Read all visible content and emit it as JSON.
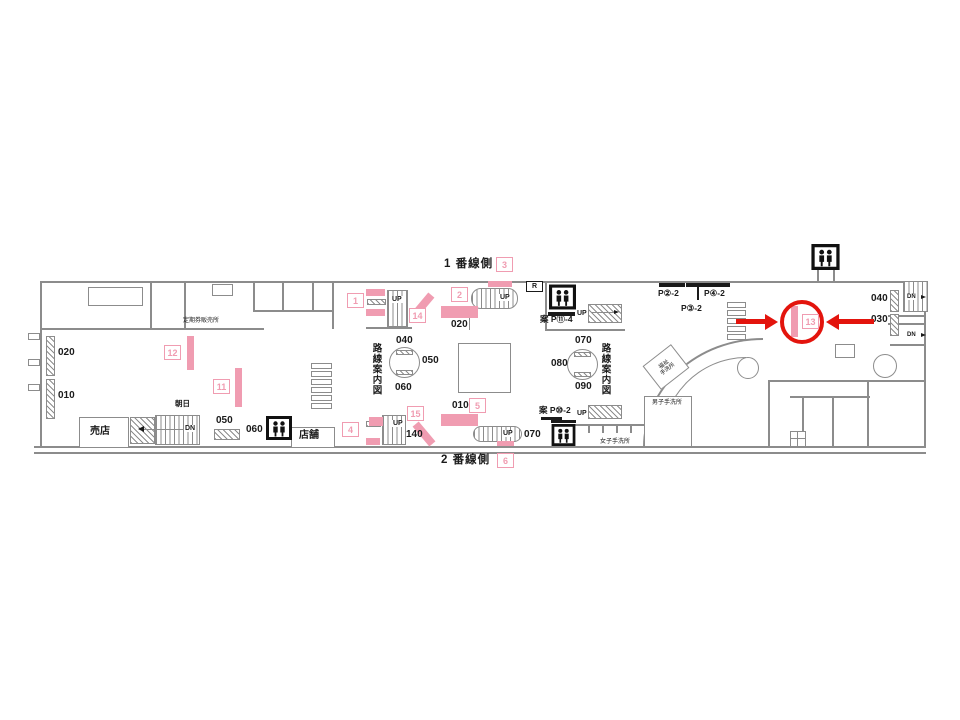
{
  "colors": {
    "pink": "#f09cb1",
    "red": "#e3140d",
    "wall": "#8c8c8c",
    "ink": "#1a1a1a"
  },
  "platform": {
    "side1": "1 番線側",
    "side2": "2 番線側"
  },
  "markers": {
    "m1": "1",
    "m2": "2",
    "m3": "3",
    "m4": "4",
    "m5": "5",
    "m6": "6",
    "m11": "11",
    "m12": "12",
    "m13": "13",
    "m14": "14",
    "m15": "15"
  },
  "highlight": {
    "circled_marker": "13"
  },
  "rooms": {
    "kiosk": "売店",
    "shop": "店舗",
    "asahi": "朝日",
    "pass_office": "定期券販売所",
    "accessible_wc_line1": "福祉",
    "accessible_wc_line2": "手洗所",
    "mens_wc": "男子手洗所",
    "womens_wc": "女子手洗所"
  },
  "signs": {
    "r": "R",
    "p11": "案 P⑪-4",
    "p10": "案 P⑩-2",
    "p2": "P②-2",
    "p4": "P④-2",
    "p3": "P③-2",
    "route_map": "路線案内図"
  },
  "dir": {
    "up": "UP",
    "dn": "DN"
  },
  "numbers": {
    "left_020": "020",
    "left_010": "010",
    "kiosk_050": "050",
    "kiosk_060": "060",
    "pillar1_040": "040",
    "pillar1_050": "050",
    "pillar1_060": "060",
    "center_020": "020",
    "center_010": "010",
    "pillar2_070": "070",
    "pillar2_080": "080",
    "pillar2_090": "090",
    "stair_140": "140",
    "esc_070": "070",
    "right_040": "040",
    "right_030": "030"
  }
}
